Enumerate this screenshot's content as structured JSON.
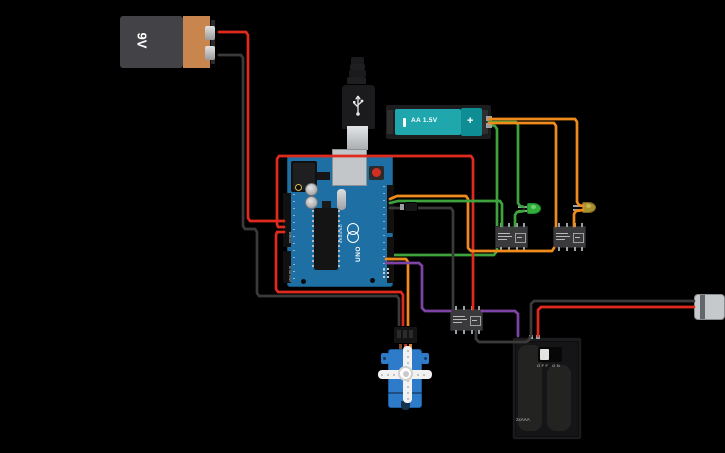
{
  "palette": {
    "background": "#000000",
    "wire_red": "#df2b1e",
    "wire_black": "#3a3a3a",
    "wire_green": "#3ea33c",
    "wire_orange": "#ef8b1d",
    "wire_purple": "#7d44a5",
    "board_blue": "#1e6fa3",
    "battery_body": "#434347",
    "battery_stripe": "#c9854e",
    "cell_teal": "#1fa7ad",
    "cell_teal_dark": "#0f8d94",
    "led_green": "#2fae3a",
    "led_yellow": "#a8922d",
    "servo_blue": "#2e7cc9",
    "horn_white": "#f2f2f2",
    "relay_body": "#3a3a3c",
    "mount_body": "#1c1c1e",
    "motor_silver": "#c6c9cc"
  },
  "components": {
    "battery_9v": {
      "label": "9V"
    },
    "battery_aa": {
      "label": "AA 1.5V",
      "plus": "+",
      "minus": "I"
    },
    "arduino": {
      "brand": "ARDUINO",
      "model": "UNO",
      "power_label": "POWER",
      "analog_label": "ANALOG IN"
    },
    "battery_mount": {
      "switch_labels": "OFF ON",
      "capacity_label": "2xAAA"
    }
  },
  "wires": [
    {
      "name": "wire-9v-positive",
      "color": "wire_red",
      "layer": "over",
      "points": [
        [
          219,
          32
        ],
        [
          246,
          32
        ],
        [
          248,
          35
        ],
        [
          248,
          218
        ],
        [
          250,
          221
        ],
        [
          284,
          221
        ]
      ]
    },
    {
      "name": "wire-9v-negative",
      "color": "wire_black",
      "layer": "over",
      "points": [
        [
          219,
          55
        ],
        [
          241,
          55
        ],
        [
          243,
          58
        ],
        [
          243,
          226
        ],
        [
          245,
          229
        ],
        [
          255,
          229
        ],
        [
          257,
          232
        ],
        [
          257,
          293
        ],
        [
          259,
          296
        ],
        [
          397,
          296
        ],
        [
          399,
          299
        ],
        [
          399,
          331
        ]
      ]
    },
    {
      "name": "wire-5v-loop",
      "color": "wire_red",
      "layer": "over",
      "points": [
        [
          284,
          227
        ],
        [
          278,
          227
        ],
        [
          277,
          224
        ],
        [
          277,
          159
        ],
        [
          279,
          156
        ],
        [
          471,
          156
        ],
        [
          473,
          159
        ],
        [
          473,
          309
        ]
      ]
    },
    {
      "name": "wire-servo-power",
      "color": "wire_red",
      "layer": "over",
      "points": [
        [
          284,
          232
        ],
        [
          277,
          232
        ],
        [
          276,
          235
        ],
        [
          276,
          289
        ],
        [
          278,
          292
        ],
        [
          401,
          292
        ],
        [
          403,
          295
        ],
        [
          403,
          331
        ]
      ]
    },
    {
      "name": "wire-servo-signal",
      "color": "wire_orange",
      "layer": "over",
      "points": [
        [
          386,
          259
        ],
        [
          406,
          259
        ],
        [
          408,
          262
        ],
        [
          408,
          331
        ]
      ]
    },
    {
      "name": "wire-gnd-black",
      "color": "wire_black",
      "layer": "over",
      "points": [
        [
          390,
          208
        ],
        [
          451,
          208
        ],
        [
          453,
          211
        ],
        [
          453,
          309
        ]
      ]
    },
    {
      "name": "wire-digital-orange",
      "color": "wire_orange",
      "layer": "over",
      "points": [
        [
          390,
          199
        ],
        [
          397,
          196
        ],
        [
          466,
          196
        ],
        [
          468,
          199
        ],
        [
          468,
          248
        ],
        [
          471,
          251
        ],
        [
          552,
          251
        ],
        [
          554,
          248
        ]
      ]
    },
    {
      "name": "wire-digital-green",
      "color": "wire_green",
      "layer": "over",
      "points": [
        [
          390,
          203
        ],
        [
          398,
          201
        ],
        [
          500,
          201
        ],
        [
          502,
          204
        ],
        [
          502,
          226
        ]
      ]
    },
    {
      "name": "wire-aa-green-return",
      "color": "wire_green",
      "layer": "under",
      "points": [
        [
          491,
          125
        ],
        [
          495,
          126
        ],
        [
          497,
          129
        ],
        [
          497,
          251
        ],
        [
          494,
          255
        ],
        [
          391,
          255
        ]
      ]
    },
    {
      "name": "wire-aa-green-led",
      "color": "wire_green",
      "layer": "over",
      "points": [
        [
          489,
          122
        ],
        [
          516,
          122
        ],
        [
          518,
          125
        ],
        [
          518,
          203
        ],
        [
          520,
          206
        ],
        [
          524,
          207
        ]
      ]
    },
    {
      "name": "wire-led-green-relay",
      "color": "wire_green",
      "layer": "over",
      "points": [
        [
          524,
          211
        ],
        [
          517,
          212
        ],
        [
          515,
          215
        ],
        [
          515,
          226
        ]
      ]
    },
    {
      "name": "wire-aa-orange-led",
      "color": "wire_orange",
      "layer": "over",
      "points": [
        [
          489,
          119
        ],
        [
          575,
          119
        ],
        [
          577,
          122
        ],
        [
          577,
          202
        ],
        [
          579,
          205
        ],
        [
          583,
          206
        ]
      ]
    },
    {
      "name": "wire-led-yellow-relay",
      "color": "wire_orange",
      "layer": "over",
      "points": [
        [
          583,
          210
        ],
        [
          576,
          211
        ],
        [
          574,
          214
        ],
        [
          574,
          226
        ]
      ]
    },
    {
      "name": "wire-aa-orange-relay",
      "color": "wire_orange",
      "layer": "over",
      "points": [
        [
          489,
          123
        ],
        [
          554,
          123
        ],
        [
          556,
          126
        ],
        [
          556,
          226
        ]
      ]
    },
    {
      "name": "wire-digital-purple",
      "color": "wire_purple",
      "layer": "over",
      "points": [
        [
          386,
          263
        ],
        [
          419,
          263
        ],
        [
          422,
          266
        ],
        [
          422,
          308
        ],
        [
          425,
          311
        ],
        [
          450,
          311
        ]
      ]
    },
    {
      "name": "wire-relay-purple",
      "color": "wire_purple",
      "layer": "over",
      "points": [
        [
          482,
          311
        ],
        [
          515,
          311
        ],
        [
          518,
          314
        ],
        [
          518,
          336
        ]
      ]
    },
    {
      "name": "wire-relay-mount-black",
      "color": "wire_black",
      "layer": "over",
      "points": [
        [
          476,
          331
        ],
        [
          476,
          339
        ],
        [
          479,
          342
        ],
        [
          526,
          342
        ],
        [
          529,
          340
        ],
        [
          530,
          337
        ]
      ]
    },
    {
      "name": "wire-mount-motor-black",
      "color": "wire_black",
      "layer": "over",
      "points": [
        [
          531,
          336
        ],
        [
          531,
          304
        ],
        [
          534,
          301
        ],
        [
          694,
          301
        ]
      ]
    },
    {
      "name": "wire-mount-motor-red",
      "color": "wire_red",
      "layer": "over",
      "points": [
        [
          538,
          336
        ],
        [
          538,
          310
        ],
        [
          541,
          307
        ],
        [
          694,
          307
        ]
      ]
    }
  ]
}
